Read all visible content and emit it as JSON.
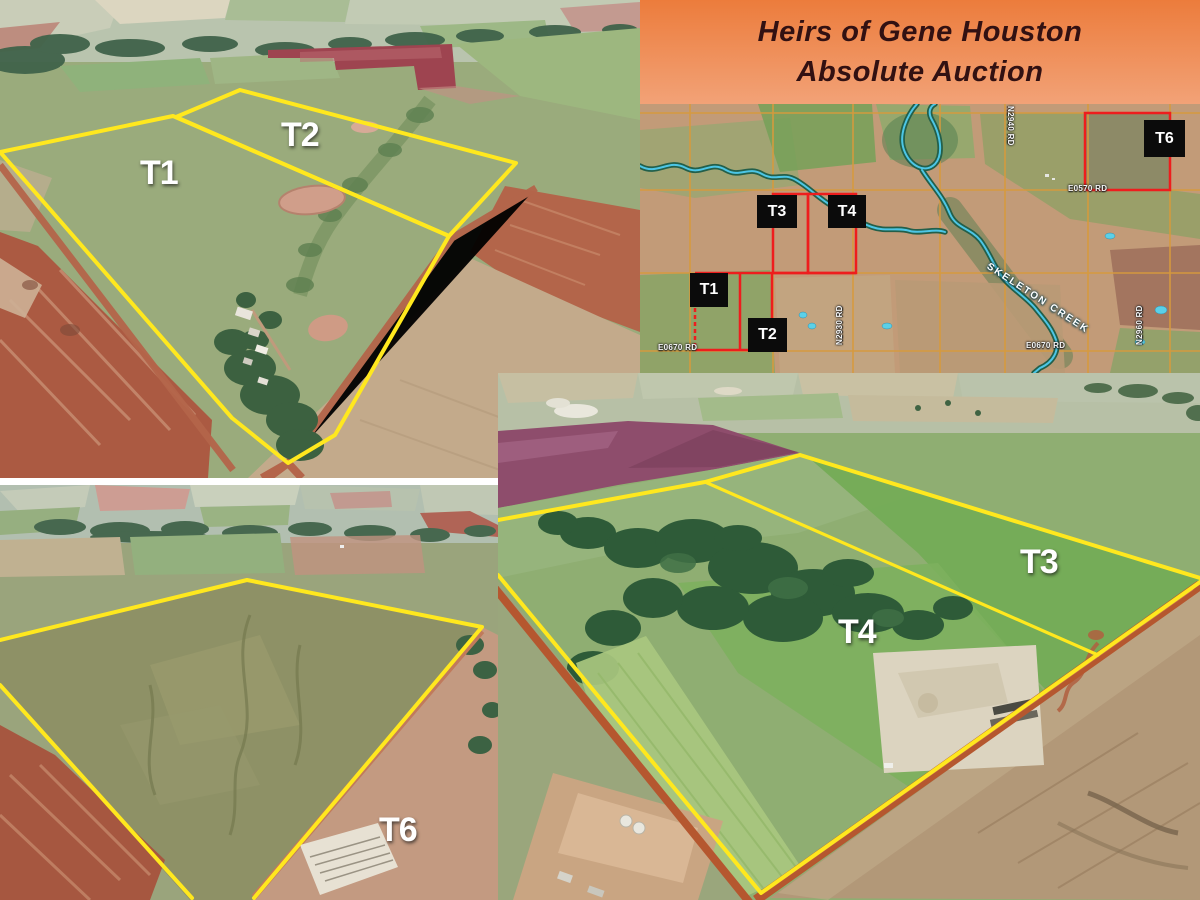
{
  "header": {
    "line1": "Heirs of Gene Houston",
    "line2": "Absolute Auction"
  },
  "photo_top_left": {
    "t1": "T1",
    "t2": "T2"
  },
  "photo_bottom_left": {
    "t6": "T6"
  },
  "photo_bottom_right": {
    "t3": "T3",
    "t4": "T4"
  },
  "map": {
    "parcel_t1": "T1",
    "parcel_t2": "T2",
    "parcel_t3": "T3",
    "parcel_t4": "T4",
    "parcel_t6": "T6",
    "road_e0670_west": "E0670 RD",
    "road_e0670_east": "E0670 RD",
    "road_e0570": "E0570 RD",
    "road_n2930": "N2930 RD",
    "road_n2940": "N2940 RD",
    "road_n2960": "N2960 RD",
    "creek": "SKELETON CREEK"
  },
  "colors": {
    "header_gradient_top": "#ec7c3c",
    "header_gradient_bottom": "#f2a277",
    "header_text": "#321112",
    "tract_outline_yellow": "#ffe81e",
    "map_parcel_red": "#ee1d1d",
    "map_label_bg": "#0b0b0b",
    "map_label_text": "#ffffff",
    "map_road_orange": "#d89a3c",
    "creek_blue": "#4cc6e6"
  }
}
